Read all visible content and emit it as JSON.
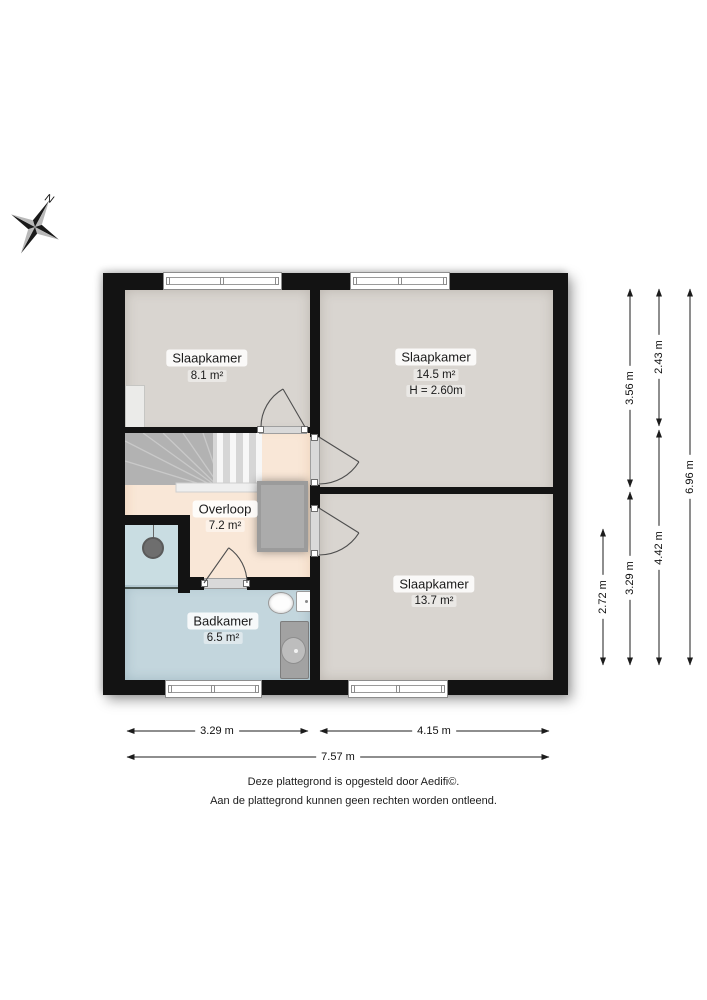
{
  "plan": {
    "compass_label": "N",
    "rooms": {
      "slaapkamer_1": {
        "name": "Slaapkamer",
        "area": "8.1 m²"
      },
      "slaapkamer_2": {
        "name": "Slaapkamer",
        "area": "14.5 m²",
        "ceiling_height": "H = 2.60m"
      },
      "slaapkamer_3": {
        "name": "Slaapkamer",
        "area": "13.7 m²"
      },
      "overloop": {
        "name": "Overloop",
        "area": "7.2 m²"
      },
      "badkamer": {
        "name": "Badkamer",
        "area": "6.5 m²"
      }
    },
    "dimensions": {
      "right_bath_height": "2.72 m",
      "right_inner_top": "3.56 m",
      "right_inner_bottom": "3.29 m",
      "right_room_top": "2.43 m",
      "right_room_bottom": "4.42 m",
      "right_total": "6.96 m",
      "bottom_left": "3.29 m",
      "bottom_right": "4.15 m",
      "bottom_total": "7.57 m"
    },
    "footer": {
      "line1": "Deze plattegrond is opgesteld door Aedifi©.",
      "line2": "Aan de plattegrond kunnen geen rechten worden ontleend."
    },
    "colors": {
      "wall": "#131313",
      "bedroom_floor": "#d9d5d0",
      "landing_floor": "#f9e7d7",
      "bathroom_floor": "#c3d6dd",
      "shower_floor": "#c9dde2",
      "rug": "#ababab"
    }
  }
}
